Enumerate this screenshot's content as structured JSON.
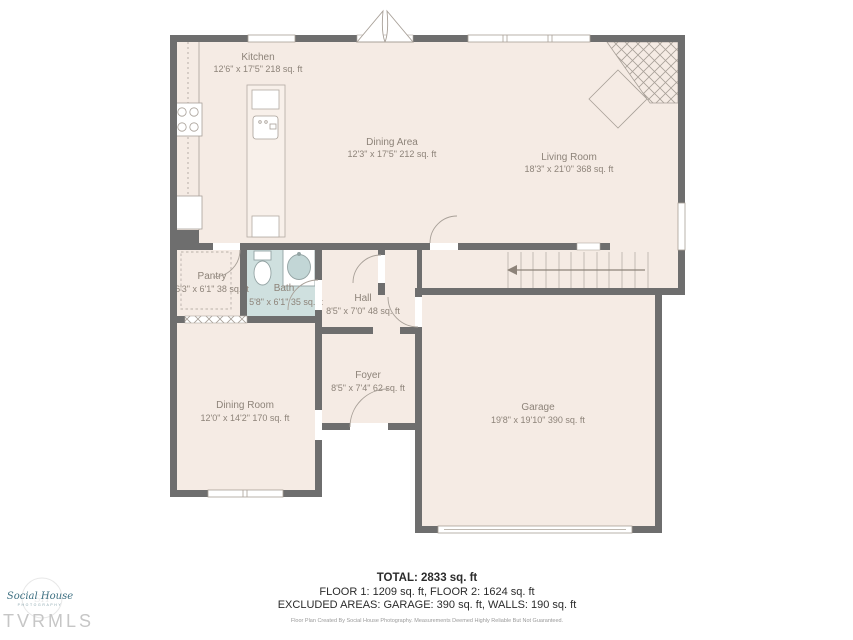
{
  "palette": {
    "floor": "#f5ebe4",
    "wall": "#6e6e6e",
    "bath_floor": "#cfe0df",
    "label": "#8d8379",
    "fixture_line": "#a8a098",
    "logo_teal": "#3f7183"
  },
  "rooms": [
    {
      "name": "Kitchen",
      "dims": "12'6\" x 17'5\" 218 sq. ft"
    },
    {
      "name": "Dining Area",
      "dims": "12'3\" x 17'5\" 212 sq. ft"
    },
    {
      "name": "Living Room",
      "dims": "18'3\" x 21'0\" 368 sq. ft"
    },
    {
      "name": "Pantry",
      "dims": "6'3\" x 6'1\" 38 sq. ft"
    },
    {
      "name": "Bath",
      "dims": "5'8\" x 6'1\" 35 sq. ft"
    },
    {
      "name": "Hall",
      "dims": "8'5\" x 7'0\" 48 sq. ft"
    },
    {
      "name": "Foyer",
      "dims": "8'5\" x 7'4\" 62 sq. ft"
    },
    {
      "name": "Dining Room",
      "dims": "12'0\" x 14'2\" 170 sq. ft"
    },
    {
      "name": "Garage",
      "dims": "19'8\" x 19'10\" 390 sq. ft"
    }
  ],
  "summary": {
    "total": "TOTAL: 2833 sq. ft",
    "floors": "FLOOR 1: 1209 sq. ft, FLOOR 2: 1624 sq. ft",
    "excluded": "EXCLUDED AREAS: GARAGE: 390 sq. ft, WALLS: 190 sq. ft",
    "disclaimer": "Floor Plan Created By Social House Photography. Measurements Deemed Highly Reliable But Not Guaranteed."
  },
  "logo": {
    "script": "Social House",
    "sub": "PHOTOGRAPHY",
    "mls": "TVRMLS"
  }
}
